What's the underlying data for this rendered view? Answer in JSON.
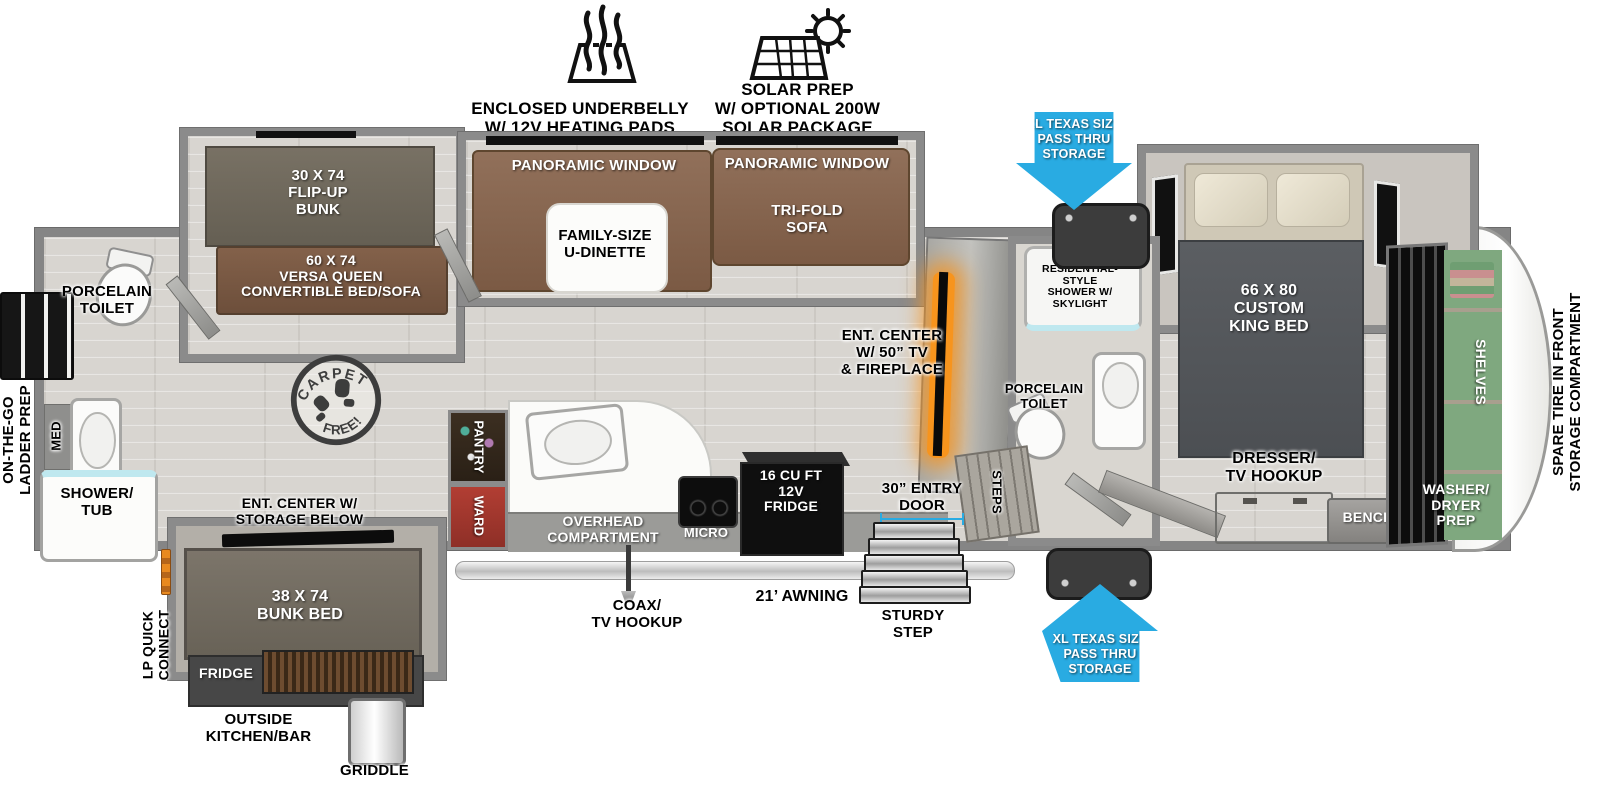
{
  "features": {
    "underbelly_label": "ENCLOSED UNDERBELLY\nW/ 12V HEATING PADS",
    "solar_label": "SOLAR PREP\nW/ OPTIONAL 200W\nSOLAR PACKAGE"
  },
  "storage": {
    "pass_thru_label": "XL TEXAS SIZE\nPASS THRU\nSTORAGE"
  },
  "exterior": {
    "awning": "21’ AWNING",
    "coax": "COAX/\nTV HOOKUP",
    "entry_door": "30” ENTRY\nDOOR",
    "sturdy_step": "STURDY\nSTEP",
    "lp_quick_connect": "LP QUICK\nCONNECT",
    "ladder_prep": "ON-THE-GO\nLADDER PREP",
    "outside_kitchen": "OUTSIDE\nKITCHEN/BAR",
    "outside_fridge": "FRIDGE",
    "griddle": "GRIDDLE",
    "spare_tire": "SPARE TIRE IN FRONT\nSTORAGE COMPARTMENT"
  },
  "bunk_room": {
    "flip_up_bunk": "30 X 74\nFLIP-UP\nBUNK",
    "versa_queen": "60 X 74\nVERSA QUEEN\nCONVERTIBLE BED/SOFA",
    "bunk_bed": "38 X 74\nBUNK BED",
    "ent_center": "ENT. CENTER W/\nSTORAGE BELOW",
    "toilet": "PORCELAIN\nTOILET",
    "shower_tub": "SHOWER/\nTUB",
    "med": "MED",
    "carpet_free_top": "CARPET",
    "carpet_free_bottom": "FREE!"
  },
  "living": {
    "panoramic_window": "PANORAMIC WINDOW",
    "u_dinette": "FAMILY-SIZE\nU-DINETTE",
    "tri_fold_sofa": "TRI-FOLD\nSOFA",
    "ent_center_tv": "ENT. CENTER\nW/ 50” TV\n& FIREPLACE"
  },
  "kitchen": {
    "pantry": "PANTRY",
    "ward": "WARD",
    "overhead": "OVERHEAD\nCOMPARTMENT",
    "micro": "MICRO",
    "fridge": "16 CU FT\n12V\nFRIDGE"
  },
  "bath": {
    "shower": "WALK-IN\nRESIDENTIAL-STYLE\nSHOWER W/\nSKYLIGHT",
    "toilet": "PORCELAIN\nTOILET",
    "steps": "STEPS"
  },
  "bedroom": {
    "king_bed": "66 X 80\nCUSTOM\nKING BED",
    "dresser": "DRESSER/\nTV HOOKUP",
    "bench": "BENCH"
  },
  "front": {
    "shelves": "SHELVES",
    "washer_dryer": "WASHER/\nDRYER\nPREP"
  },
  "colors": {
    "accent_blue": "#29abe2",
    "sofa_brown": "#8b6a50",
    "fireplace_orange": "#f7941d",
    "ward_red": "#b03a30",
    "bed_gray": "#54575b"
  }
}
